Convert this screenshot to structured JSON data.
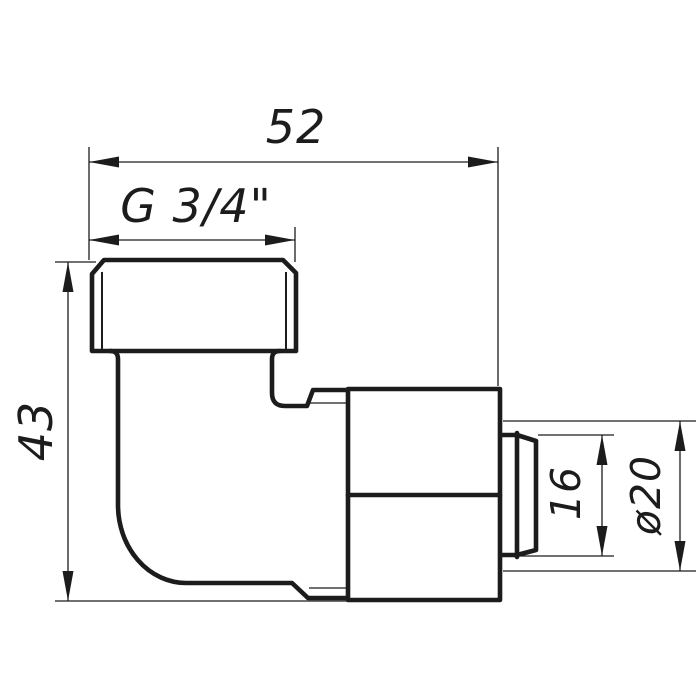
{
  "drawing": {
    "labels": {
      "overall_width": "52",
      "thread_size": "G 3/4\"",
      "overall_height": "43",
      "insert_depth": "16",
      "pipe_diameter": "ø20"
    },
    "colors": {
      "line": "#1c1c1c",
      "background": "#ffffff"
    }
  }
}
